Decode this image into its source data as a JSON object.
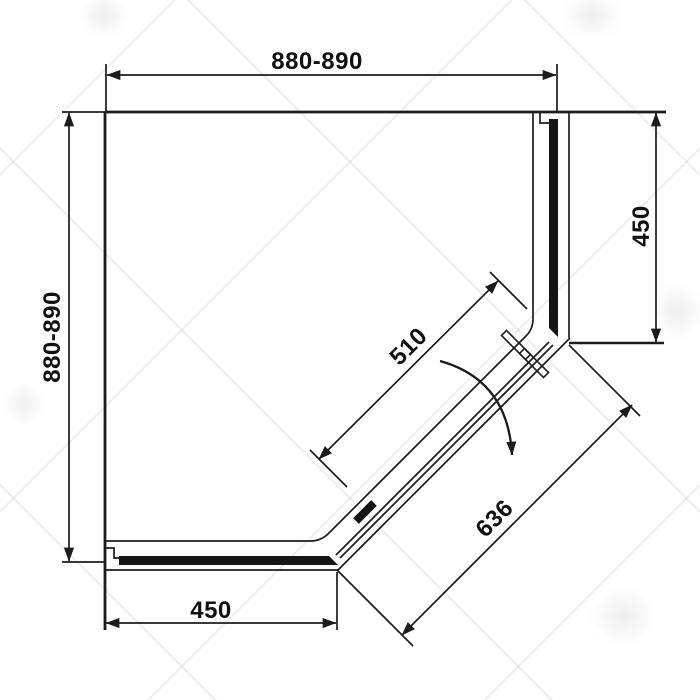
{
  "drawing": {
    "dimensions": {
      "top": "880-890",
      "left": "880-890",
      "right": "450",
      "bottom": "450",
      "door": "510",
      "diagonal": "636"
    },
    "colors": {
      "line": "#1c1c1c",
      "background": "#ffffff",
      "watermark": "#e9e9e9"
    }
  }
}
